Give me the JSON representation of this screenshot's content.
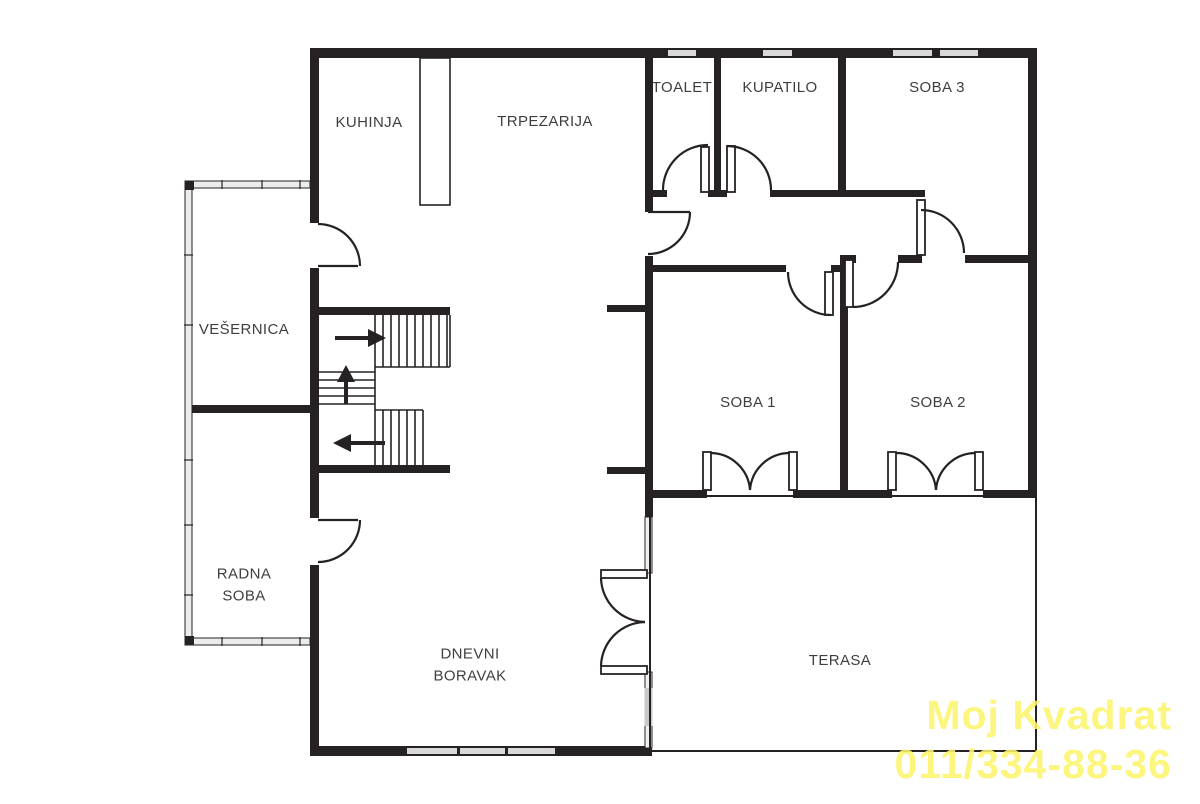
{
  "plan": {
    "rooms": {
      "kuhinja": {
        "label": "KUHINJA"
      },
      "trpezarija": {
        "label": "TRPEZARIJA"
      },
      "toalet": {
        "label": "TOALET"
      },
      "kupatilo": {
        "label": "KUPATILO"
      },
      "soba3": {
        "label": "SOBA 3"
      },
      "vesernica": {
        "label": "VEŠERNICA"
      },
      "soba1": {
        "label": "SOBA 1"
      },
      "soba2": {
        "label": "SOBA 2"
      },
      "radna_soba": {
        "label": "RADNA SOBA"
      },
      "dnevni_boravak": {
        "label": "DNEVNI BORAVAK"
      },
      "terasa": {
        "label": "TERASA"
      }
    },
    "stairs": {
      "direction_arrows": [
        "right",
        "up",
        "left"
      ]
    }
  },
  "watermark": {
    "line1": "Moj Kvadrat",
    "line2": "011/334-88-36",
    "color": "#fcf46d"
  },
  "colors": {
    "background": "#ffffff",
    "wall": "#262223",
    "window": "#d9d9d9",
    "label": "#3f3f3f"
  }
}
